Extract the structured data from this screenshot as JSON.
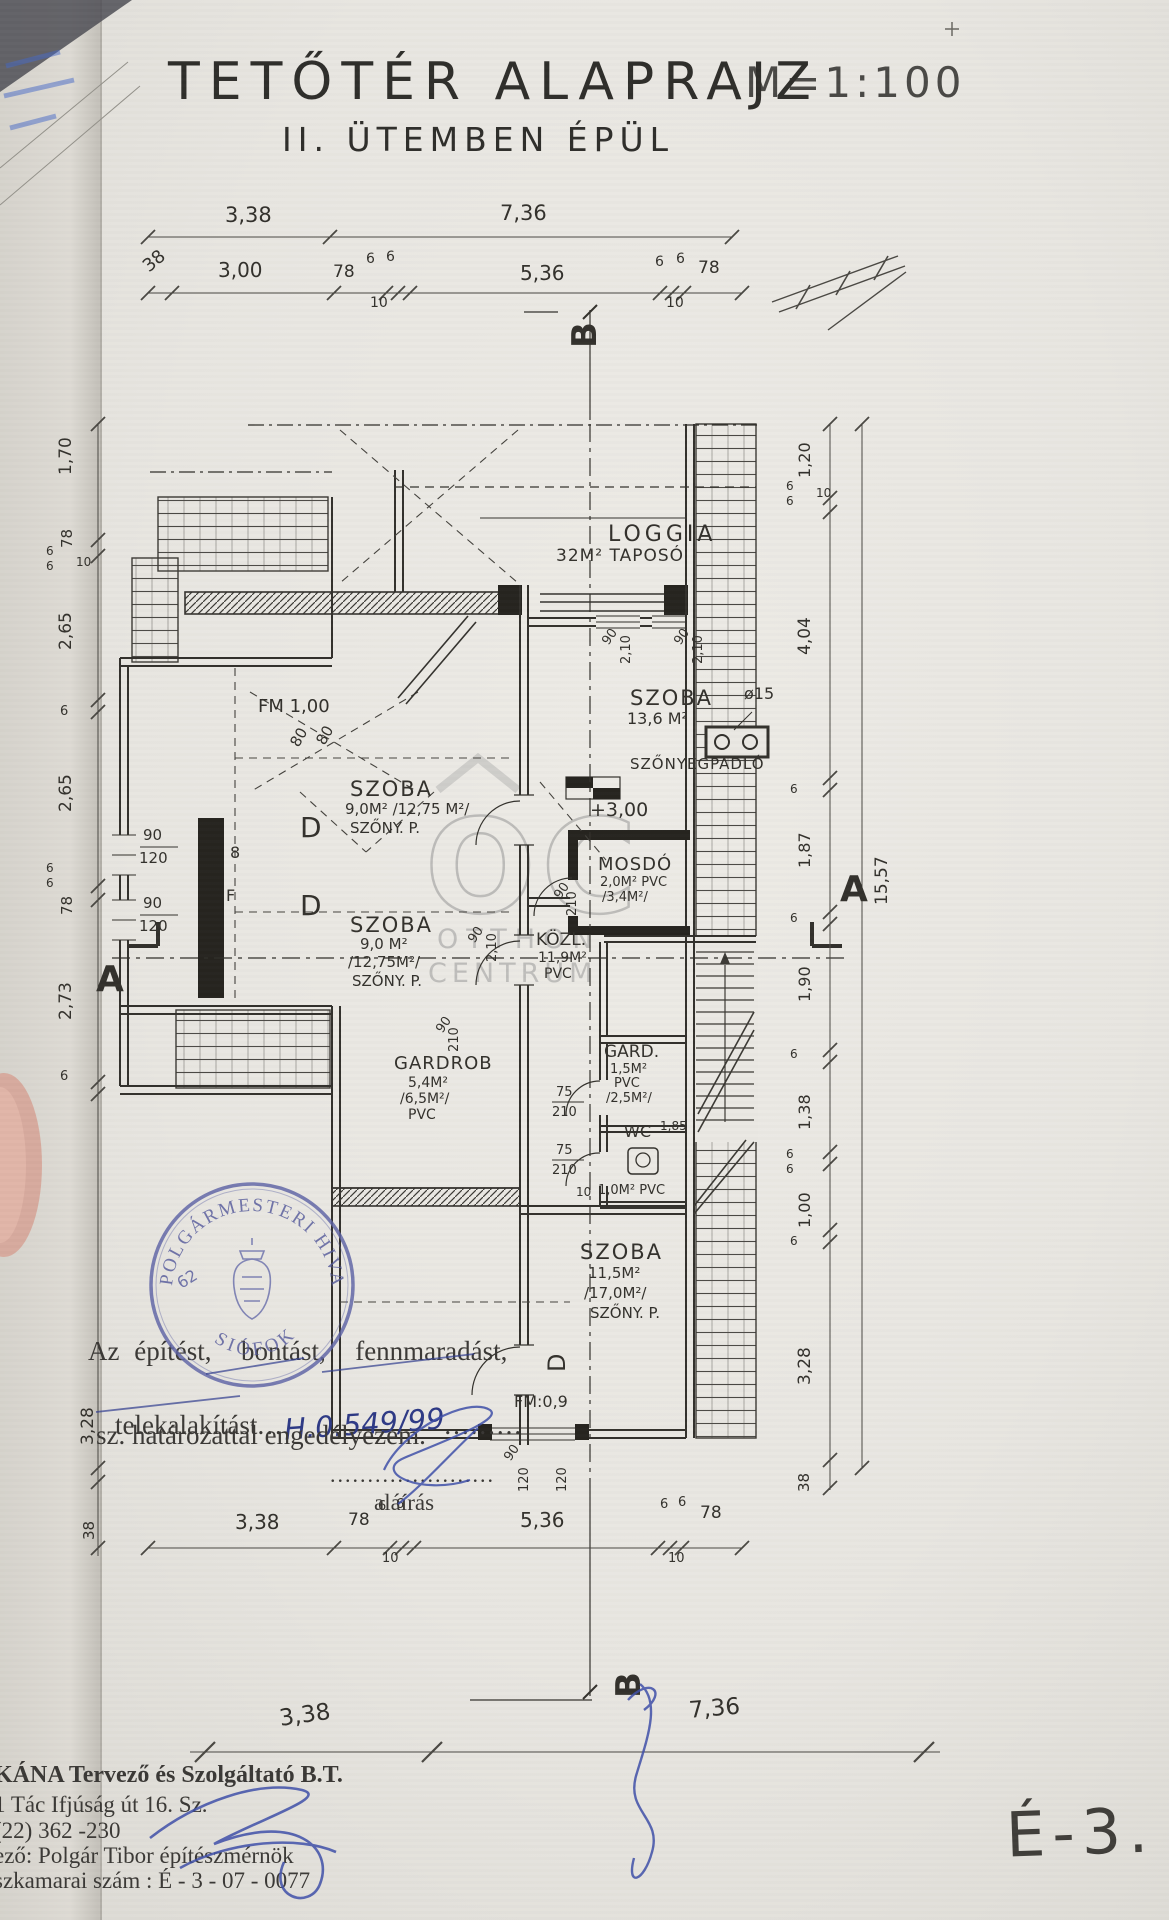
{
  "title": {
    "main": "TETŐTÉR ALAPRAJZ",
    "scale": "M=1:100",
    "subtitle": "II. ÜTEMBEN ÉPÜL"
  },
  "sheet": {
    "number": "É-3."
  },
  "approval": {
    "line1": "Az építést,  bontást,  fennmaradást,",
    "line2_prefix": "telekalakítást",
    "line2_dots1": "...",
    "line2_number": "H.0.549/99",
    "line2_dots2": ".........",
    "line3": "sz. határozattal engedélyezem.",
    "dots_line": "......................",
    "signature_label": "aláírás"
  },
  "stamp": {
    "ring_text_top": "POLGÁRMESTERI HIVATAL",
    "ring_text_bottom": "SIÓFOK",
    "number": "62"
  },
  "company": {
    "line1": "KÁNA Tervező és Szolgáltató B.T.",
    "line2": "1 Tác Ifjúság út 16. Sz.",
    "line3": "(22) 362 -230",
    "line4": "ező: Polgár Tibor építészmérnök",
    "line5": "szkamarai szám : É - 3 - 07 - 0077"
  },
  "watermark": {
    "logo": "OC",
    "line1": "OTTHON",
    "line2": "CENTRUM"
  },
  "annotations": [
    {
      "n": "dim-top-338",
      "t": "3,38",
      "x": 225,
      "y": 205,
      "fs": 21
    },
    {
      "n": "dim-top-736",
      "t": "7,36",
      "x": 500,
      "y": 203,
      "fs": 21
    },
    {
      "n": "dim-top2-38",
      "t": "38",
      "x": 140,
      "y": 262,
      "fs": 18,
      "r": -40
    },
    {
      "n": "dim-top2-300",
      "t": "3,00",
      "x": 218,
      "y": 260,
      "fs": 20
    },
    {
      "n": "dim-top2-78a",
      "t": "78",
      "x": 333,
      "y": 264,
      "fs": 17
    },
    {
      "n": "dim-top2-6a",
      "t": "6",
      "x": 366,
      "y": 252,
      "fs": 14
    },
    {
      "n": "dim-top2-6b",
      "t": "6",
      "x": 386,
      "y": 250,
      "fs": 14
    },
    {
      "n": "dim-top2-10a",
      "t": "10",
      "x": 370,
      "y": 296,
      "fs": 14
    },
    {
      "n": "dim-top2-536",
      "t": "5,36",
      "x": 520,
      "y": 263,
      "fs": 20
    },
    {
      "n": "dim-top2-6c",
      "t": "6",
      "x": 655,
      "y": 255,
      "fs": 14
    },
    {
      "n": "dim-top2-6d",
      "t": "6",
      "x": 676,
      "y": 252,
      "fs": 14
    },
    {
      "n": "dim-top2-78b",
      "t": "78",
      "x": 698,
      "y": 260,
      "fs": 17
    },
    {
      "n": "dim-top2-10b",
      "t": "10",
      "x": 666,
      "y": 296,
      "fs": 14
    },
    {
      "n": "marker-b-top",
      "t": "B",
      "x": 568,
      "y": 348,
      "fs": 34,
      "r": -90,
      "w": 600
    },
    {
      "n": "dim-left-170",
      "t": "1,70",
      "x": 58,
      "y": 475,
      "fs": 17,
      "r": -90
    },
    {
      "n": "dim-left-78a",
      "t": "78",
      "x": 60,
      "y": 548,
      "fs": 15,
      "r": -90
    },
    {
      "n": "dim-left-6a",
      "t": "6",
      "x": 46,
      "y": 545,
      "fs": 12
    },
    {
      "n": "dim-left-6b",
      "t": "6",
      "x": 46,
      "y": 560,
      "fs": 12
    },
    {
      "n": "dim-left-10",
      "t": "10",
      "x": 76,
      "y": 556,
      "fs": 12
    },
    {
      "n": "dim-left-265a",
      "t": "2,65",
      "x": 58,
      "y": 650,
      "fs": 17,
      "r": -90
    },
    {
      "n": "dim-left-6c",
      "t": "6",
      "x": 60,
      "y": 705,
      "fs": 13
    },
    {
      "n": "dim-left-265b",
      "t": "2,65",
      "x": 58,
      "y": 812,
      "fs": 17,
      "r": -90
    },
    {
      "n": "dim-left-6d",
      "t": "6",
      "x": 46,
      "y": 862,
      "fs": 12
    },
    {
      "n": "dim-left-6e",
      "t": "6",
      "x": 46,
      "y": 877,
      "fs": 12
    },
    {
      "n": "dim-left-78b",
      "t": "78",
      "x": 60,
      "y": 915,
      "fs": 15,
      "r": -90
    },
    {
      "n": "dim-left-273",
      "t": "2,73",
      "x": 58,
      "y": 1020,
      "fs": 17,
      "r": -90
    },
    {
      "n": "dim-left-6f",
      "t": "6",
      "x": 60,
      "y": 1070,
      "fs": 13
    },
    {
      "n": "dim-left-328",
      "t": "3,28",
      "x": 80,
      "y": 1445,
      "fs": 17,
      "r": -90
    },
    {
      "n": "dim-left-38",
      "t": "38",
      "x": 82,
      "y": 1540,
      "fs": 15,
      "r": -90
    },
    {
      "n": "marker-a-left",
      "t": "A",
      "x": 96,
      "y": 962,
      "fs": 36,
      "w": 600
    },
    {
      "n": "dim-right-120",
      "t": "1,20",
      "x": 797,
      "y": 478,
      "fs": 16,
      "r": -90
    },
    {
      "n": "dim-right-6a",
      "t": "6",
      "x": 786,
      "y": 480,
      "fs": 12
    },
    {
      "n": "dim-right-6b",
      "t": "6",
      "x": 786,
      "y": 495,
      "fs": 12
    },
    {
      "n": "dim-right-10",
      "t": "10",
      "x": 816,
      "y": 487,
      "fs": 12
    },
    {
      "n": "dim-right-404",
      "t": "4,04",
      "x": 797,
      "y": 655,
      "fs": 17,
      "r": -90
    },
    {
      "n": "dim-right-6c",
      "t": "6",
      "x": 790,
      "y": 783,
      "fs": 12
    },
    {
      "n": "dim-right-187",
      "t": "1,87",
      "x": 797,
      "y": 868,
      "fs": 16,
      "r": -90
    },
    {
      "n": "dim-right-6d",
      "t": "6",
      "x": 790,
      "y": 912,
      "fs": 12
    },
    {
      "n": "dim-right-190",
      "t": "1,90",
      "x": 797,
      "y": 1002,
      "fs": 16,
      "r": -90
    },
    {
      "n": "dim-right-6e",
      "t": "6",
      "x": 790,
      "y": 1048,
      "fs": 12
    },
    {
      "n": "dim-right-138",
      "t": "1,38",
      "x": 797,
      "y": 1130,
      "fs": 16,
      "r": -90
    },
    {
      "n": "dim-right-6f",
      "t": "6",
      "x": 786,
      "y": 1148,
      "fs": 12
    },
    {
      "n": "dim-right-6g",
      "t": "6",
      "x": 786,
      "y": 1163,
      "fs": 12
    },
    {
      "n": "dim-right-100",
      "t": "1,00",
      "x": 797,
      "y": 1228,
      "fs": 16,
      "r": -90
    },
    {
      "n": "dim-right-6h",
      "t": "6",
      "x": 790,
      "y": 1235,
      "fs": 12
    },
    {
      "n": "dim-right-328",
      "t": "3,28",
      "x": 797,
      "y": 1385,
      "fs": 17,
      "r": -90
    },
    {
      "n": "dim-right-38",
      "t": "38",
      "x": 797,
      "y": 1492,
      "fs": 15,
      "r": -90
    },
    {
      "n": "dim-right-1557",
      "t": "15,57",
      "x": 874,
      "y": 905,
      "fs": 17,
      "r": -90
    },
    {
      "n": "marker-a-right",
      "t": "A",
      "x": 840,
      "y": 872,
      "fs": 36,
      "w": 600
    },
    {
      "n": "room-loggia",
      "t": "LOGGIA",
      "x": 608,
      "y": 524,
      "fs": 22,
      "ls": 4
    },
    {
      "n": "room-loggia-area",
      "t": "32M² TAPOSÓ",
      "x": 556,
      "y": 548,
      "fs": 17,
      "ls": 1
    },
    {
      "n": "room-szoba-ne",
      "t": "SZOBA",
      "x": 630,
      "y": 688,
      "fs": 21,
      "ls": 2
    },
    {
      "n": "label-skylight",
      "t": "ø15",
      "x": 744,
      "y": 686,
      "fs": 16
    },
    {
      "n": "room-szoba-ne-area",
      "t": "13,6 M²",
      "x": 627,
      "y": 711,
      "fs": 16
    },
    {
      "n": "room-szoba-ne-floor",
      "t": "SZŐNYEGPADLÓ",
      "x": 630,
      "y": 757,
      "fs": 15,
      "ls": 1
    },
    {
      "n": "label-fm100",
      "t": "FM 1,00",
      "x": 258,
      "y": 698,
      "fs": 18
    },
    {
      "n": "label-fm-80a",
      "t": "80",
      "x": 288,
      "y": 742,
      "fs": 15,
      "r": -60
    },
    {
      "n": "label-fm-80b",
      "t": "80",
      "x": 314,
      "y": 740,
      "fs": 15,
      "r": -60
    },
    {
      "n": "dim-win-90a",
      "t": "90",
      "x": 600,
      "y": 640,
      "fs": 13,
      "r": -55
    },
    {
      "n": "dim-win-210a",
      "t": "2,10",
      "x": 620,
      "y": 664,
      "fs": 13,
      "r": -90
    },
    {
      "n": "dim-win-90b",
      "t": "90",
      "x": 672,
      "y": 640,
      "fs": 13,
      "r": -55
    },
    {
      "n": "dim-win-210b",
      "t": "2,10",
      "x": 692,
      "y": 664,
      "fs": 13,
      "r": -90
    },
    {
      "n": "label-level",
      "t": "+3,00",
      "x": 590,
      "y": 801,
      "fs": 19
    },
    {
      "n": "room-szoba-w1",
      "t": "SZOBA",
      "x": 350,
      "y": 779,
      "fs": 21,
      "ls": 2
    },
    {
      "n": "room-szoba-w1-area",
      "t": "9,0M² /12,75 M²/",
      "x": 345,
      "y": 802,
      "fs": 15
    },
    {
      "n": "room-szoba-w1-floor",
      "t": "SZŐNY. P.",
      "x": 350,
      "y": 821,
      "fs": 15
    },
    {
      "n": "label-door-d1",
      "t": "D",
      "x": 300,
      "y": 814,
      "fs": 28
    },
    {
      "n": "dim-w-90a",
      "t": "90",
      "x": 143,
      "y": 828,
      "fs": 15
    },
    {
      "n": "dim-w-120a",
      "t": "120",
      "x": 139,
      "y": 851,
      "fs": 15
    },
    {
      "n": "label-sym-8",
      "t": "8",
      "x": 230,
      "y": 845,
      "fs": 16
    },
    {
      "n": "label-sym-f",
      "t": "F",
      "x": 226,
      "y": 888,
      "fs": 16
    },
    {
      "n": "dim-w-90b",
      "t": "90",
      "x": 143,
      "y": 896,
      "fs": 15
    },
    {
      "n": "dim-w-120b",
      "t": "120",
      "x": 139,
      "y": 919,
      "fs": 15
    },
    {
      "n": "label-door-d2",
      "t": "D",
      "x": 300,
      "y": 892,
      "fs": 28
    },
    {
      "n": "room-szoba-w2",
      "t": "SZOBA",
      "x": 350,
      "y": 915,
      "fs": 21,
      "ls": 2
    },
    {
      "n": "room-szoba-w2-area",
      "t": "9,0 M²",
      "x": 360,
      "y": 937,
      "fs": 15
    },
    {
      "n": "room-szoba-w2-area2",
      "t": "/12,75M²/",
      "x": 348,
      "y": 955,
      "fs": 15
    },
    {
      "n": "room-szoba-w2-floor",
      "t": "SZŐNY. P.",
      "x": 352,
      "y": 974,
      "fs": 15
    },
    {
      "n": "dim-door-90",
      "t": "90",
      "x": 466,
      "y": 938,
      "fs": 13,
      "r": -55
    },
    {
      "n": "dim-door-210",
      "t": "2,10",
      "x": 486,
      "y": 962,
      "fs": 13,
      "r": -90
    },
    {
      "n": "room-mosdo",
      "t": "MOSDÓ",
      "x": 598,
      "y": 856,
      "fs": 18,
      "ls": 1
    },
    {
      "n": "room-mosdo-area",
      "t": "2,0M² PVC",
      "x": 600,
      "y": 876,
      "fs": 13
    },
    {
      "n": "room-mosdo-area2",
      "t": "/3,4M²/",
      "x": 602,
      "y": 891,
      "fs": 13
    },
    {
      "n": "dim-mosdo-90",
      "t": "90",
      "x": 552,
      "y": 894,
      "fs": 13,
      "r": -55
    },
    {
      "n": "dim-mosdo-210",
      "t": "210",
      "x": 566,
      "y": 916,
      "fs": 13,
      "r": -90
    },
    {
      "n": "room-kozl",
      "t": "KÖZL.",
      "x": 536,
      "y": 932,
      "fs": 17
    },
    {
      "n": "room-kozl-area",
      "t": "11,9M²",
      "x": 538,
      "y": 951,
      "fs": 14
    },
    {
      "n": "room-kozl-floor",
      "t": "PVC",
      "x": 544,
      "y": 967,
      "fs": 14
    },
    {
      "n": "room-gardrob",
      "t": "GARDROB",
      "x": 394,
      "y": 1055,
      "fs": 18,
      "ls": 1
    },
    {
      "n": "room-gardrob-area",
      "t": "5,4M²",
      "x": 408,
      "y": 1076,
      "fs": 14
    },
    {
      "n": "room-gardrob-area2",
      "t": "/6,5M²/",
      "x": 400,
      "y": 1092,
      "fs": 14
    },
    {
      "n": "room-gardrob-floor",
      "t": "PVC",
      "x": 408,
      "y": 1108,
      "fs": 14
    },
    {
      "n": "dim-gardrob-90",
      "t": "90",
      "x": 434,
      "y": 1028,
      "fs": 13,
      "r": -55
    },
    {
      "n": "dim-gardrob-210",
      "t": "210",
      "x": 448,
      "y": 1052,
      "fs": 13,
      "r": -90
    },
    {
      "n": "room-gard",
      "t": "GARD.",
      "x": 604,
      "y": 1044,
      "fs": 17
    },
    {
      "n": "room-gard-area",
      "t": "1,5M²",
      "x": 610,
      "y": 1063,
      "fs": 13
    },
    {
      "n": "room-gard-floor",
      "t": "PVC",
      "x": 614,
      "y": 1077,
      "fs": 13
    },
    {
      "n": "room-gard-area2",
      "t": "/2,5M²/",
      "x": 606,
      "y": 1092,
      "fs": 13
    },
    {
      "n": "dim-gard-75",
      "t": "75",
      "x": 556,
      "y": 1086,
      "fs": 13
    },
    {
      "n": "dim-gard-210",
      "t": "210",
      "x": 552,
      "y": 1106,
      "fs": 13
    },
    {
      "n": "room-wc",
      "t": "WC",
      "x": 624,
      "y": 1124,
      "fs": 16
    },
    {
      "n": "room-wc-h",
      "t": "1,85",
      "x": 660,
      "y": 1120,
      "fs": 12
    },
    {
      "n": "dim-wc-75",
      "t": "75",
      "x": 556,
      "y": 1144,
      "fs": 13
    },
    {
      "n": "dim-wc-210",
      "t": "210",
      "x": 552,
      "y": 1164,
      "fs": 13
    },
    {
      "n": "dim-wc-10",
      "t": "10",
      "x": 576,
      "y": 1186,
      "fs": 12
    },
    {
      "n": "room-wc-area",
      "t": "1,0M² PVC",
      "x": 598,
      "y": 1184,
      "fs": 13
    },
    {
      "n": "room-szoba-s",
      "t": "SZOBA",
      "x": 580,
      "y": 1242,
      "fs": 21,
      "ls": 2
    },
    {
      "n": "room-szoba-s-area",
      "t": "11,5M²",
      "x": 588,
      "y": 1266,
      "fs": 15
    },
    {
      "n": "room-szoba-s-area2",
      "t": "/17,0M²/",
      "x": 584,
      "y": 1286,
      "fs": 15
    },
    {
      "n": "room-szoba-s-floor",
      "t": "SZŐNY. P.",
      "x": 590,
      "y": 1306,
      "fs": 15
    },
    {
      "n": "label-door-d3",
      "t": "D",
      "x": 545,
      "y": 1372,
      "fs": 24,
      "r": -90
    },
    {
      "n": "label-fm09",
      "t": "FM:0,9",
      "x": 514,
      "y": 1394,
      "fs": 16
    },
    {
      "n": "dim-s-90",
      "t": "90",
      "x": 502,
      "y": 1456,
      "fs": 13,
      "r": -55
    },
    {
      "n": "dim-s-120",
      "t": "120",
      "x": 518,
      "y": 1492,
      "fs": 13,
      "r": -90
    },
    {
      "n": "dim-s-120b",
      "t": "120",
      "x": 556,
      "y": 1492,
      "fs": 13,
      "r": -90
    },
    {
      "n": "dim-bot1-338",
      "t": "3,38",
      "x": 235,
      "y": 1512,
      "fs": 20
    },
    {
      "n": "dim-bot1-78a",
      "t": "78",
      "x": 348,
      "y": 1512,
      "fs": 17
    },
    {
      "n": "dim-bot1-6a",
      "t": "6",
      "x": 378,
      "y": 1500,
      "fs": 13
    },
    {
      "n": "dim-bot1-6b",
      "t": "6",
      "x": 396,
      "y": 1498,
      "fs": 13
    },
    {
      "n": "dim-bot1-10a",
      "t": "10",
      "x": 382,
      "y": 1552,
      "fs": 13
    },
    {
      "n": "dim-bot1-536",
      "t": "5,36",
      "x": 520,
      "y": 1510,
      "fs": 20
    },
    {
      "n": "dim-bot1-6c",
      "t": "6",
      "x": 660,
      "y": 1498,
      "fs": 13
    },
    {
      "n": "dim-bot1-6d",
      "t": "6",
      "x": 678,
      "y": 1496,
      "fs": 13
    },
    {
      "n": "dim-bot1-78b",
      "t": "78",
      "x": 700,
      "y": 1505,
      "fs": 17
    },
    {
      "n": "dim-bot1-10b",
      "t": "10",
      "x": 668,
      "y": 1552,
      "fs": 13
    },
    {
      "n": "dim-bot2-338",
      "t": "3,38",
      "x": 278,
      "y": 1708,
      "fs": 23,
      "r": -8
    },
    {
      "n": "dim-bot2-736",
      "t": "7,36",
      "x": 688,
      "y": 1700,
      "fs": 23,
      "r": -5
    },
    {
      "n": "marker-b-bottom",
      "t": "B",
      "x": 612,
      "y": 1698,
      "fs": 34,
      "r": -90,
      "w": 600
    }
  ]
}
